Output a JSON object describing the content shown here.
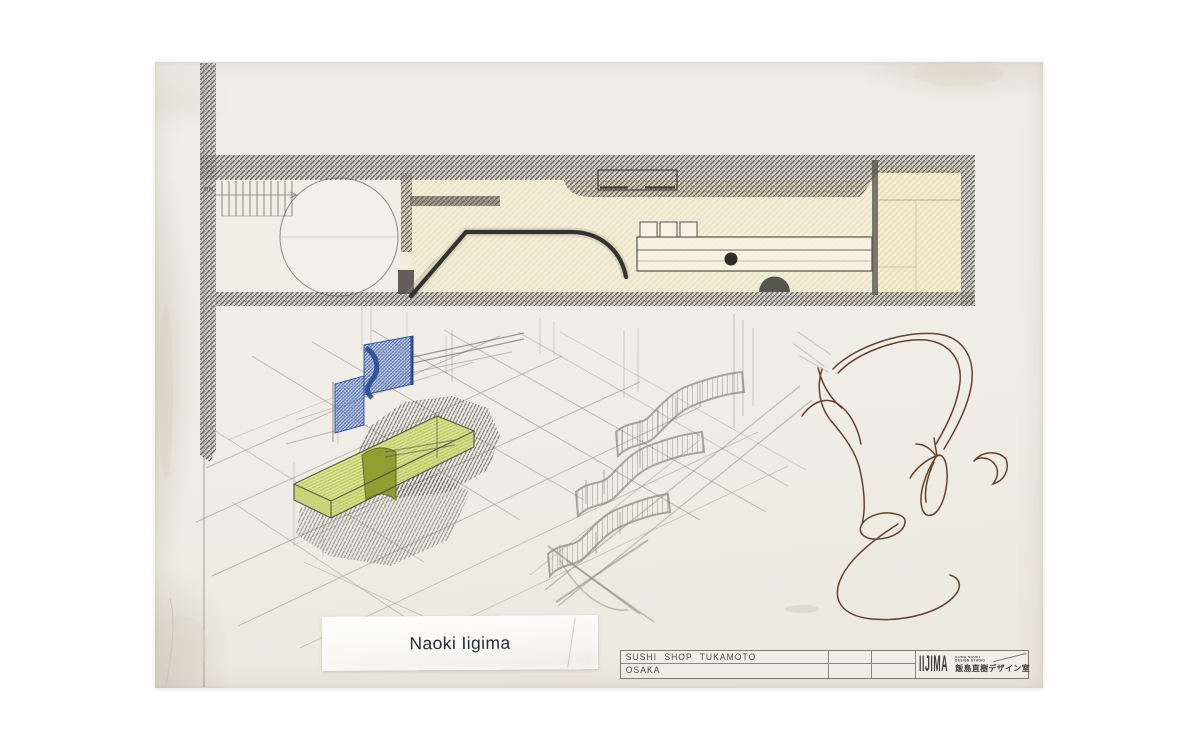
{
  "sheet": {
    "artist_label": "Naoki Iigima",
    "plan": {
      "stair_label": "DN"
    },
    "title_block": {
      "project_name": "SUSHI SHOP TUKAMOTO",
      "project_city": "OSAKA",
      "logo_text": "IIJIMA",
      "logo_sub1": "IIJIMA NAOKI",
      "logo_sub2": "DESIGN STUDIO",
      "logo_jp": "飯島直樹デザイン室"
    },
    "colors": {
      "paper": "#f0eee6",
      "pencil_dark": "#35342f",
      "wall_hatch": "#55534c",
      "blue_screen": "#3558ab",
      "green_counter": "#b7c254",
      "floor_tint": "#f2ecd6",
      "ink_brown": "#5a3222"
    }
  }
}
